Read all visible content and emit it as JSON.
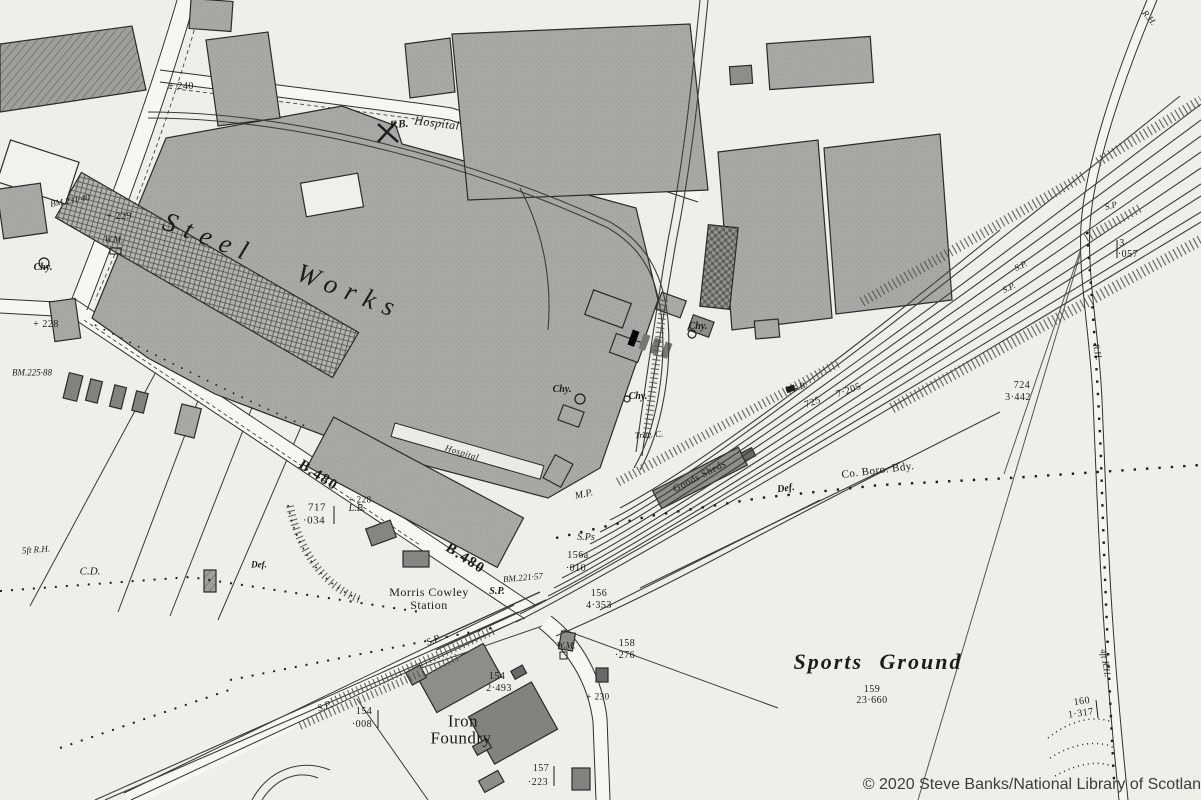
{
  "map_title": "Steel Works (historic Ordnance Survey extract, Morris Cowley)",
  "attribution": {
    "text": "© 2020 Steve Banks/National Library of Scotlan"
  },
  "colors": {
    "paper": "#f0eee8",
    "ink": "#1d1c1a",
    "building": "#a9a8a4",
    "rail": "#3d3c38"
  },
  "labels": [
    {
      "name": "label-steel-works",
      "text": "Steel Works",
      "x": 283,
      "y": 266,
      "rot": 21,
      "fs": 27,
      "cls": "maj"
    },
    {
      "name": "label-fb",
      "text": "F.B.",
      "x": 399,
      "y": 125,
      "rot": -5,
      "fs": 11,
      "cls": "ftb"
    },
    {
      "name": "label-hospital-top",
      "text": "Hospital",
      "x": 437,
      "y": 123,
      "rot": 7,
      "fs": 12,
      "cls": "pli"
    },
    {
      "name": "label-hospital-works",
      "text": "Hospital",
      "x": 462,
      "y": 453,
      "rot": 17,
      "fs": 9,
      "cls": "pli"
    },
    {
      "name": "label-morris-cowley",
      "text": "Morris Cowley",
      "x": 429,
      "y": 592,
      "rot": 0,
      "fs": 12,
      "cls": "pl"
    },
    {
      "name": "label-station",
      "text": "Station",
      "x": 429,
      "y": 605,
      "rot": 0,
      "fs": 12,
      "cls": "pl"
    },
    {
      "name": "label-iron",
      "text": "Iron",
      "x": 463,
      "y": 721,
      "rot": 0,
      "fs": 17,
      "cls": "pl"
    },
    {
      "name": "label-foundry",
      "text": "Foundry",
      "x": 461,
      "y": 738,
      "rot": 0,
      "fs": 17,
      "cls": "pl"
    },
    {
      "name": "label-sports-ground",
      "text": "Sports Ground",
      "x": 878,
      "y": 662,
      "rot": 0,
      "fs": 22,
      "cls": "pli2"
    },
    {
      "name": "parcel-159",
      "text": "159",
      "x": 872,
      "y": 690,
      "rot": 0,
      "fs": 10,
      "cls": "pc"
    },
    {
      "name": "acreage-159",
      "text": "23·660",
      "x": 872,
      "y": 701,
      "rot": 0,
      "fs": 10,
      "cls": "pc"
    },
    {
      "name": "parcel-717",
      "text": "717",
      "x": 317,
      "y": 508,
      "rot": 0,
      "fs": 11,
      "cls": "pc"
    },
    {
      "name": "acreage-717",
      "text": "·034",
      "x": 314,
      "y": 521,
      "rot": 0,
      "fs": 11,
      "cls": "pc"
    },
    {
      "name": "parcel-724",
      "text": "724",
      "x": 1022,
      "y": 386,
      "rot": 0,
      "fs": 10,
      "cls": "pc"
    },
    {
      "name": "acreage-724",
      "text": "3·442",
      "x": 1018,
      "y": 398,
      "rot": 0,
      "fs": 10,
      "cls": "pc"
    },
    {
      "name": "parcel-725",
      "text": "725",
      "x": 813,
      "y": 403,
      "rot": -20,
      "fs": 10,
      "cls": "pc"
    },
    {
      "name": "acreage-725",
      "text": "7·205",
      "x": 849,
      "y": 391,
      "rot": -20,
      "fs": 10,
      "cls": "pc"
    },
    {
      "name": "label-sb",
      "text": "S.B.",
      "x": 800,
      "y": 387,
      "rot": -20,
      "fs": 9,
      "cls": "ft"
    },
    {
      "name": "label-goods-sheds",
      "text": "Goods Sheds",
      "x": 700,
      "y": 477,
      "rot": -27,
      "fs": 10,
      "cls": "pl"
    },
    {
      "name": "label-def-1",
      "text": "Def.",
      "x": 786,
      "y": 489,
      "rot": -8,
      "fs": 10,
      "cls": "ftb"
    },
    {
      "name": "label-def-2",
      "text": "Def.",
      "x": 259,
      "y": 565,
      "rot": 0,
      "fs": 9,
      "cls": "ftb"
    },
    {
      "name": "label-co-boro-bdy",
      "text": "Co. Boro. Bdy.",
      "x": 878,
      "y": 471,
      "rot": -7,
      "fs": 11,
      "cls": "pl"
    },
    {
      "name": "label-mp",
      "text": "M.P.",
      "x": 584,
      "y": 495,
      "rot": -12,
      "fs": 10,
      "cls": "ft"
    },
    {
      "name": "label-sps",
      "text": "S.Ps",
      "x": 586,
      "y": 538,
      "rot": 0,
      "fs": 10,
      "cls": "ft"
    },
    {
      "name": "parcel-156a",
      "text": "156a",
      "x": 578,
      "y": 556,
      "rot": 0,
      "fs": 10,
      "cls": "pc"
    },
    {
      "name": "acreage-156a",
      "text": "·010",
      "x": 576,
      "y": 569,
      "rot": 0,
      "fs": 10,
      "cls": "pc"
    },
    {
      "name": "parcel-156",
      "text": "156",
      "x": 599,
      "y": 594,
      "rot": 0,
      "fs": 10,
      "cls": "pc"
    },
    {
      "name": "acreage-156",
      "text": "4·353",
      "x": 599,
      "y": 606,
      "rot": 0,
      "fs": 10,
      "cls": "pc"
    },
    {
      "name": "parcel-158",
      "text": "158",
      "x": 627,
      "y": 644,
      "rot": 0,
      "fs": 10,
      "cls": "pc"
    },
    {
      "name": "acreage-158",
      "text": "·276",
      "x": 625,
      "y": 656,
      "rot": 0,
      "fs": 10,
      "cls": "pc"
    },
    {
      "name": "label-wm-1",
      "text": "W.M.",
      "x": 566,
      "y": 646,
      "rot": 0,
      "fs": 9,
      "cls": "ft"
    },
    {
      "name": "label-wm-2",
      "text": "W.M.",
      "x": 114,
      "y": 240,
      "rot": 0,
      "fs": 9,
      "cls": "ft"
    },
    {
      "name": "label-chy-1",
      "text": "Chy.",
      "x": 43,
      "y": 268,
      "rot": 0,
      "fs": 10,
      "cls": "ftb"
    },
    {
      "name": "label-chy-2",
      "text": "Chy.",
      "x": 562,
      "y": 390,
      "rot": 0,
      "fs": 10,
      "cls": "ftb"
    },
    {
      "name": "label-chy-3",
      "text": "Chy.",
      "x": 638,
      "y": 397,
      "rot": 0,
      "fs": 10,
      "cls": "ftb"
    },
    {
      "name": "label-chy-4",
      "text": "Chy.",
      "x": 698,
      "y": 327,
      "rot": 0,
      "fs": 10,
      "cls": "ftb"
    },
    {
      "name": "label-trav-c",
      "text": "Trav. C.",
      "x": 649,
      "y": 435,
      "rot": -4,
      "fs": 9,
      "cls": "ft"
    },
    {
      "name": "road-b480-1",
      "text": "B.480",
      "x": 318,
      "y": 476,
      "rot": 33,
      "fs": 15,
      "cls": "rd"
    },
    {
      "name": "road-b480-2",
      "text": "B.480",
      "x": 465,
      "y": 559,
      "rot": 33,
      "fs": 15,
      "cls": "rd"
    },
    {
      "name": "benchmark-231",
      "text": "BM.231·40",
      "x": 70,
      "y": 201,
      "rot": -10,
      "fs": 9,
      "cls": "ft"
    },
    {
      "name": "benchmark-225",
      "text": "BM.225·88",
      "x": 32,
      "y": 373,
      "rot": 0,
      "fs": 9,
      "cls": "ft"
    },
    {
      "name": "benchmark-221",
      "text": "BM.221·57",
      "x": 523,
      "y": 578,
      "rot": -5,
      "fs": 9,
      "cls": "ft"
    },
    {
      "name": "spot-height-229",
      "text": "+ 229",
      "x": 119,
      "y": 217,
      "rot": 0,
      "fs": 10,
      "cls": "pc"
    },
    {
      "name": "spot-height-228a",
      "text": "+ 228",
      "x": 46,
      "y": 325,
      "rot": 0,
      "fs": 10,
      "cls": "pc"
    },
    {
      "name": "spot-height-228b",
      "text": "+ 228",
      "x": 360,
      "y": 500,
      "rot": 0,
      "fs": 9,
      "cls": "pc"
    },
    {
      "name": "spot-height-240",
      "text": "+ 240",
      "x": 181,
      "y": 87,
      "rot": 0,
      "fs": 10,
      "cls": "pc"
    },
    {
      "name": "spot-height-230",
      "text": "+ 230",
      "x": 598,
      "y": 697,
      "rot": 0,
      "fs": 9,
      "cls": "pc"
    },
    {
      "name": "label-lb",
      "text": "L.B.",
      "x": 357,
      "y": 509,
      "rot": 0,
      "fs": 10,
      "cls": "ft"
    },
    {
      "name": "label-cd",
      "text": "C.D.",
      "x": 90,
      "y": 572,
      "rot": 0,
      "fs": 11,
      "cls": "ft"
    },
    {
      "name": "label-5ft-rh",
      "text": "5ft R.H.",
      "x": 36,
      "y": 550,
      "rot": -4,
      "fs": 9,
      "cls": "ft"
    },
    {
      "name": "label-sp-1",
      "text": "S.P.",
      "x": 497,
      "y": 592,
      "rot": 0,
      "fs": 10,
      "cls": "ftb"
    },
    {
      "name": "label-sp-2",
      "text": "S.P.",
      "x": 434,
      "y": 641,
      "rot": -22,
      "fs": 10,
      "cls": "ft"
    },
    {
      "name": "label-sp-3",
      "text": "S.P.",
      "x": 325,
      "y": 707,
      "rot": -22,
      "fs": 10,
      "cls": "ft"
    },
    {
      "name": "label-sp-4",
      "text": "S.P.",
      "x": 1009,
      "y": 288,
      "rot": -25,
      "fs": 9,
      "cls": "ft"
    },
    {
      "name": "label-sp-5",
      "text": "S.P.",
      "x": 1021,
      "y": 266,
      "rot": -25,
      "fs": 9,
      "cls": "ft"
    },
    {
      "name": "label-sp-6",
      "text": "S.P",
      "x": 1111,
      "y": 206,
      "rot": -15,
      "fs": 9,
      "cls": "ft"
    },
    {
      "name": "parcel-3",
      "text": "3",
      "x": 1122,
      "y": 244,
      "rot": 0,
      "fs": 10,
      "cls": "pc"
    },
    {
      "name": "acreage-3",
      "text": "·057",
      "x": 1128,
      "y": 255,
      "rot": 0,
      "fs": 10,
      "cls": "pc"
    },
    {
      "name": "parcel-160",
      "text": "160",
      "x": 1082,
      "y": 702,
      "rot": -8,
      "fs": 10,
      "cls": "pc"
    },
    {
      "name": "acreage-160",
      "text": "1·317",
      "x": 1081,
      "y": 714,
      "rot": -8,
      "fs": 10,
      "cls": "pc"
    },
    {
      "name": "label-rh-mid",
      "text": "R.H.",
      "x": 1097,
      "y": 352,
      "rot": 78,
      "fs": 9,
      "cls": "ft"
    },
    {
      "name": "label-rh-top",
      "text": "R.H.",
      "x": 1149,
      "y": 18,
      "rot": 50,
      "fs": 9,
      "cls": "ft"
    },
    {
      "name": "label-4ft-rh",
      "text": "4ft R.H.",
      "x": 1105,
      "y": 663,
      "rot": 80,
      "fs": 9,
      "cls": "ft"
    },
    {
      "name": "parcel-157",
      "text": "157",
      "x": 541,
      "y": 769,
      "rot": 0,
      "fs": 10,
      "cls": "pc"
    },
    {
      "name": "acreage-157",
      "text": "·223",
      "x": 538,
      "y": 783,
      "rot": 0,
      "fs": 10,
      "cls": "pc"
    },
    {
      "name": "parcel-154a",
      "text": "154",
      "x": 497,
      "y": 677,
      "rot": 0,
      "fs": 10,
      "cls": "pc"
    },
    {
      "name": "acreage-154a",
      "text": "2·493",
      "x": 499,
      "y": 689,
      "rot": 0,
      "fs": 10,
      "cls": "pc"
    },
    {
      "name": "parcel-154b",
      "text": "154",
      "x": 364,
      "y": 712,
      "rot": 0,
      "fs": 10,
      "cls": "pc"
    },
    {
      "name": "acreage-154b",
      "text": "·008",
      "x": 362,
      "y": 725,
      "rot": 0,
      "fs": 10,
      "cls": "pc"
    }
  ]
}
